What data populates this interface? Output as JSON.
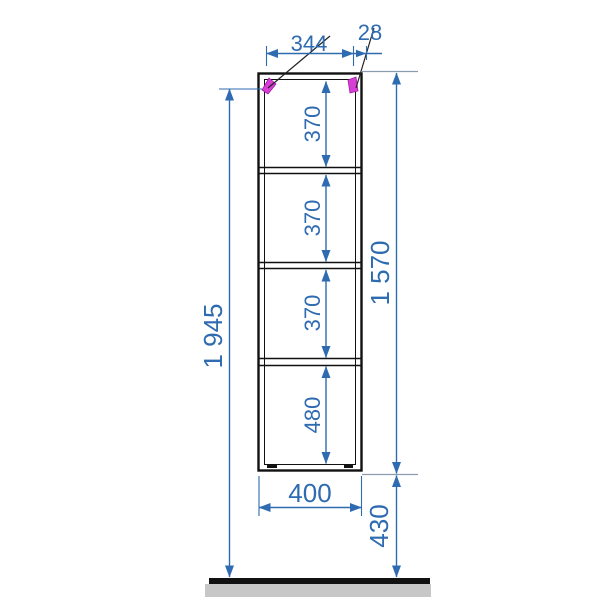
{
  "drawing": {
    "kind": "furniture-dimension-drawing-front-elevation"
  },
  "dimensions": {
    "inner_width": "344",
    "side_panel_thickness": "28",
    "compartments": [
      "370",
      "370",
      "370",
      "480"
    ],
    "frame_height": "1 570",
    "mounting_height": "1 945",
    "outer_width": "400",
    "floor_clearance": "430"
  },
  "colors": {
    "dimension": "#2e6bb0",
    "extension_gray": "#8d9bb0",
    "bracket": "#d63ed6",
    "frame": "#111111",
    "ground_fill": "#c7c7c7"
  }
}
